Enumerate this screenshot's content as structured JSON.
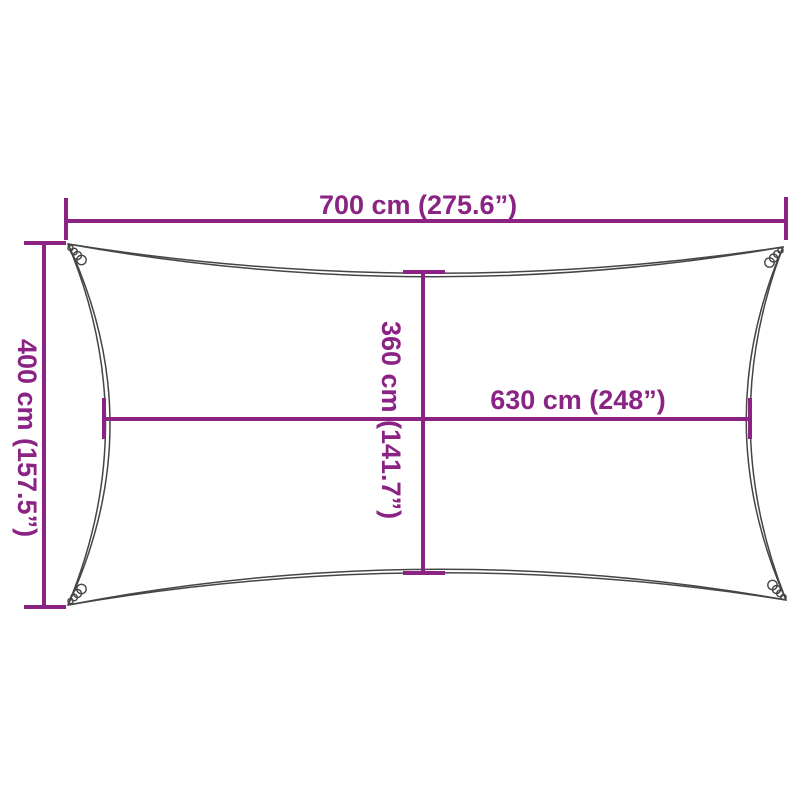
{
  "colors": {
    "accent": "#8A2383",
    "outline": "#454545",
    "background": "#FFFFFF"
  },
  "labels": {
    "width_top": "700 cm (275.6”)",
    "height_left": "400 cm (157.5”)",
    "height_middle": "360 cm (141.7”)",
    "width_middle": "630 cm (248”)"
  }
}
